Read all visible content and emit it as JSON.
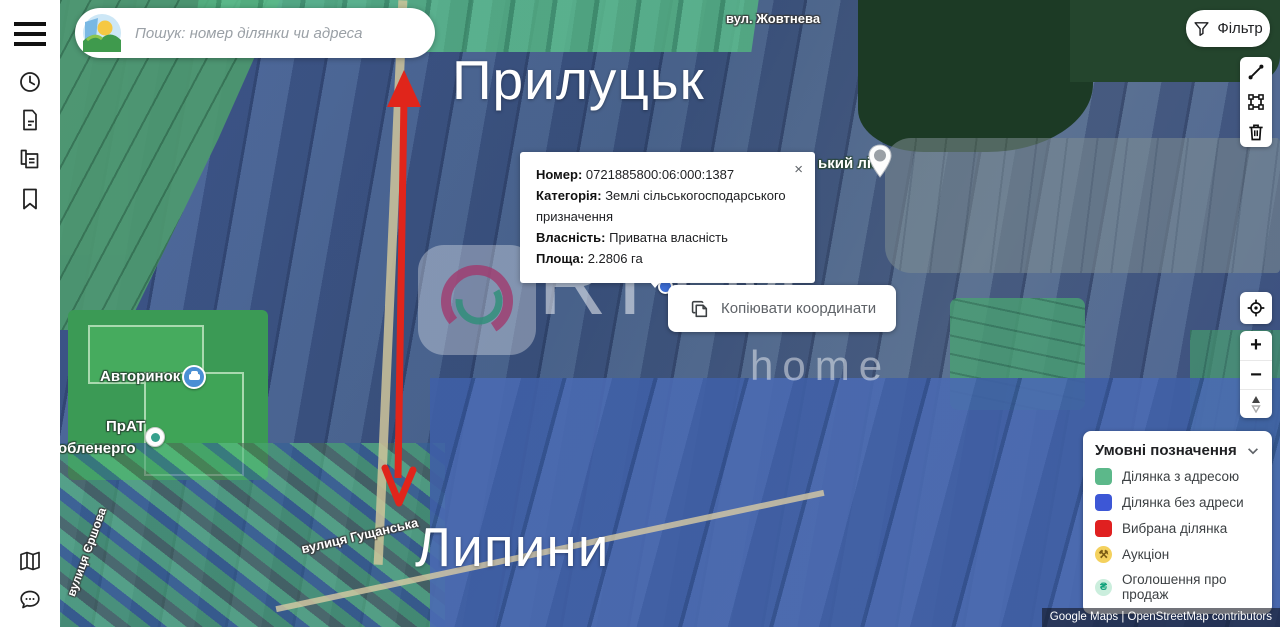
{
  "header": {
    "search_placeholder": "Пошук: номер ділянки чи адреса",
    "filter_label": "Фільтр"
  },
  "sidebar": {
    "icons": [
      "hamburger-menu-icon",
      "history-clock-icon",
      "document-icon",
      "copy-documents-icon",
      "bookmark-icon",
      "map-icon",
      "chat-icon"
    ]
  },
  "map_toolbar": {
    "tools": [
      "measure-distance",
      "select-area",
      "delete-drawing"
    ]
  },
  "map_controls": {
    "zoom_in": "+",
    "zoom_out": "−"
  },
  "parcel_popup": {
    "close": "×",
    "fields": [
      {
        "label": "Номер:",
        "value": "0721885800:06:000:1387"
      },
      {
        "label": "Категорія:",
        "value": "Землі сільськогосподарського призначення"
      },
      {
        "label": "Власність:",
        "value": "Приватна власність"
      },
      {
        "label": "Площа:",
        "value": "2.2806 га"
      }
    ],
    "copy_button_label": "Копіювати координати"
  },
  "legend": {
    "title": "Умовні позначення",
    "items": [
      {
        "label": "Ділянка з адресою",
        "color": "#5CB88A",
        "shape": "square"
      },
      {
        "label": "Ділянка без адреси",
        "color": "#3D57D6",
        "shape": "square"
      },
      {
        "label": "Вибрана ділянка",
        "color": "#E02020",
        "shape": "square"
      },
      {
        "label": "Аукціон",
        "color": "#F4D15E",
        "shape": "circle",
        "glyph": "⚒"
      },
      {
        "label": "Оголошення про продаж",
        "color": "#CBEEDD",
        "shape": "circle",
        "glyph": "₴"
      }
    ]
  },
  "map_labels": {
    "city_top": "Прилуцьк",
    "city_bottom": "Липини",
    "street_top": "вул. Жовтнева",
    "forest_partial": "ький ліс",
    "poi_car_market": "Авторинок",
    "poi_energy_line1": "ПрАТ",
    "poi_energy_line2": "обленерго",
    "street_left": "вулиця Єршова",
    "street_bottom": "вулиця Гущанська",
    "arrow_color": "#E0251B"
  },
  "watermark": {
    "brand": "RITM",
    "sub": "home"
  },
  "attribution": "Google Maps | OpenStreetMap contributors"
}
